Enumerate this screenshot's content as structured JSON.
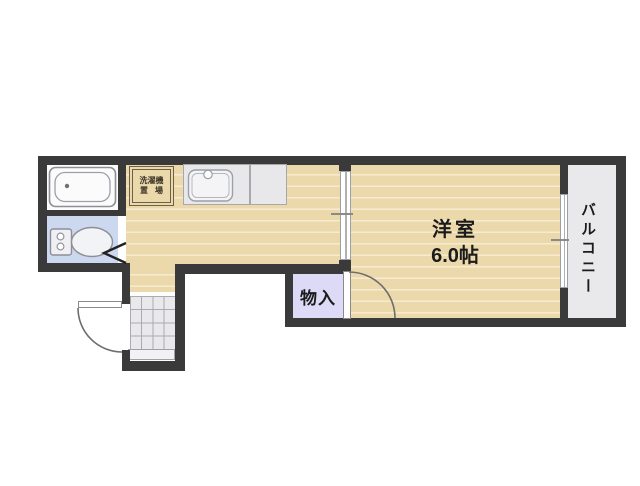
{
  "plan": {
    "rooms": {
      "western_room": {
        "label": "洋室",
        "size": "6.0帖"
      },
      "storage": {
        "label": "物入"
      },
      "balcony": {
        "label": "バルコニー"
      },
      "laundry": {
        "line1": "洗濯機",
        "line2": "置場"
      }
    },
    "colors": {
      "wall": "#3a3a3a",
      "wood": "#ecd9ab",
      "wood_stripe": "#f7ebcf",
      "gray_floor": "#e9e9ec",
      "tile_line": "#aaaab0",
      "toilet_floor": "#ccd8f0",
      "storage_floor": "#dcdaf6",
      "fixture": "#8e8e94",
      "laundry_border": "#6a6147",
      "door_line": "#9aa0a6",
      "swing_line": "#6e6e6e",
      "text": "#1b1b1b"
    }
  }
}
